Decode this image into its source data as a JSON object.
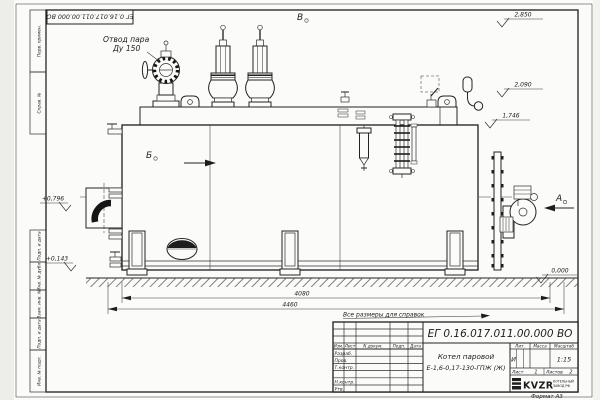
{
  "page": {
    "stamp_rotated": "ЕГ 0.16.017.011.00.000  ВО",
    "format_label": "Формат А3",
    "reference_note": "Все размеры для справок"
  },
  "views": {
    "a": "А",
    "b": "Б",
    "v": "В"
  },
  "callouts": {
    "steam_line1": "Отвод пара",
    "steam_line2": "Ду 150"
  },
  "elevations": {
    "top": "2,850",
    "deck": "2,090",
    "shell_top": "1,746",
    "ground": "0,000",
    "mid": "+0,796",
    "low": "+0,143"
  },
  "dimensions": {
    "inner_length": "4080",
    "overall_length": "4460"
  },
  "margin_labels": [
    "Перв. примен.",
    "Справ. №",
    "Подп. и дата",
    "Инв. № дубл.",
    "Взам. инв. №",
    "Подп. и дата",
    "Инв. № подл."
  ],
  "titleblock": {
    "doc_number": "ЕГ 0.16.017.011.00.000  ВО",
    "product_line1": "Котел паровой",
    "product_line2": "Е-1,6-0,17-130-ГПЖ (Ж)",
    "col_izm": "Изм.",
    "col_list": "Лист",
    "col_ndoc": "N докум.",
    "col_podp": "Подп.",
    "col_data": "Дата",
    "row_razrab": "Разраб.",
    "row_prov": "Пров.",
    "row_tkontr": "Т.контр.",
    "row_nkontr": "Н.контр.",
    "row_utv": "Утв.",
    "lit_label": "Лит.",
    "lit_value": "И",
    "mass_label": "Масса",
    "scale_label": "Масштаб",
    "scale_value": "1:15",
    "sheet_label": "Лист",
    "sheet_value": "1",
    "sheets_label": "Листов",
    "sheets_value": "2",
    "logo": "KVZR",
    "org_line1": "КОТЕЛЬНЫЙ",
    "org_line2": "ЗАВОД РФ"
  }
}
